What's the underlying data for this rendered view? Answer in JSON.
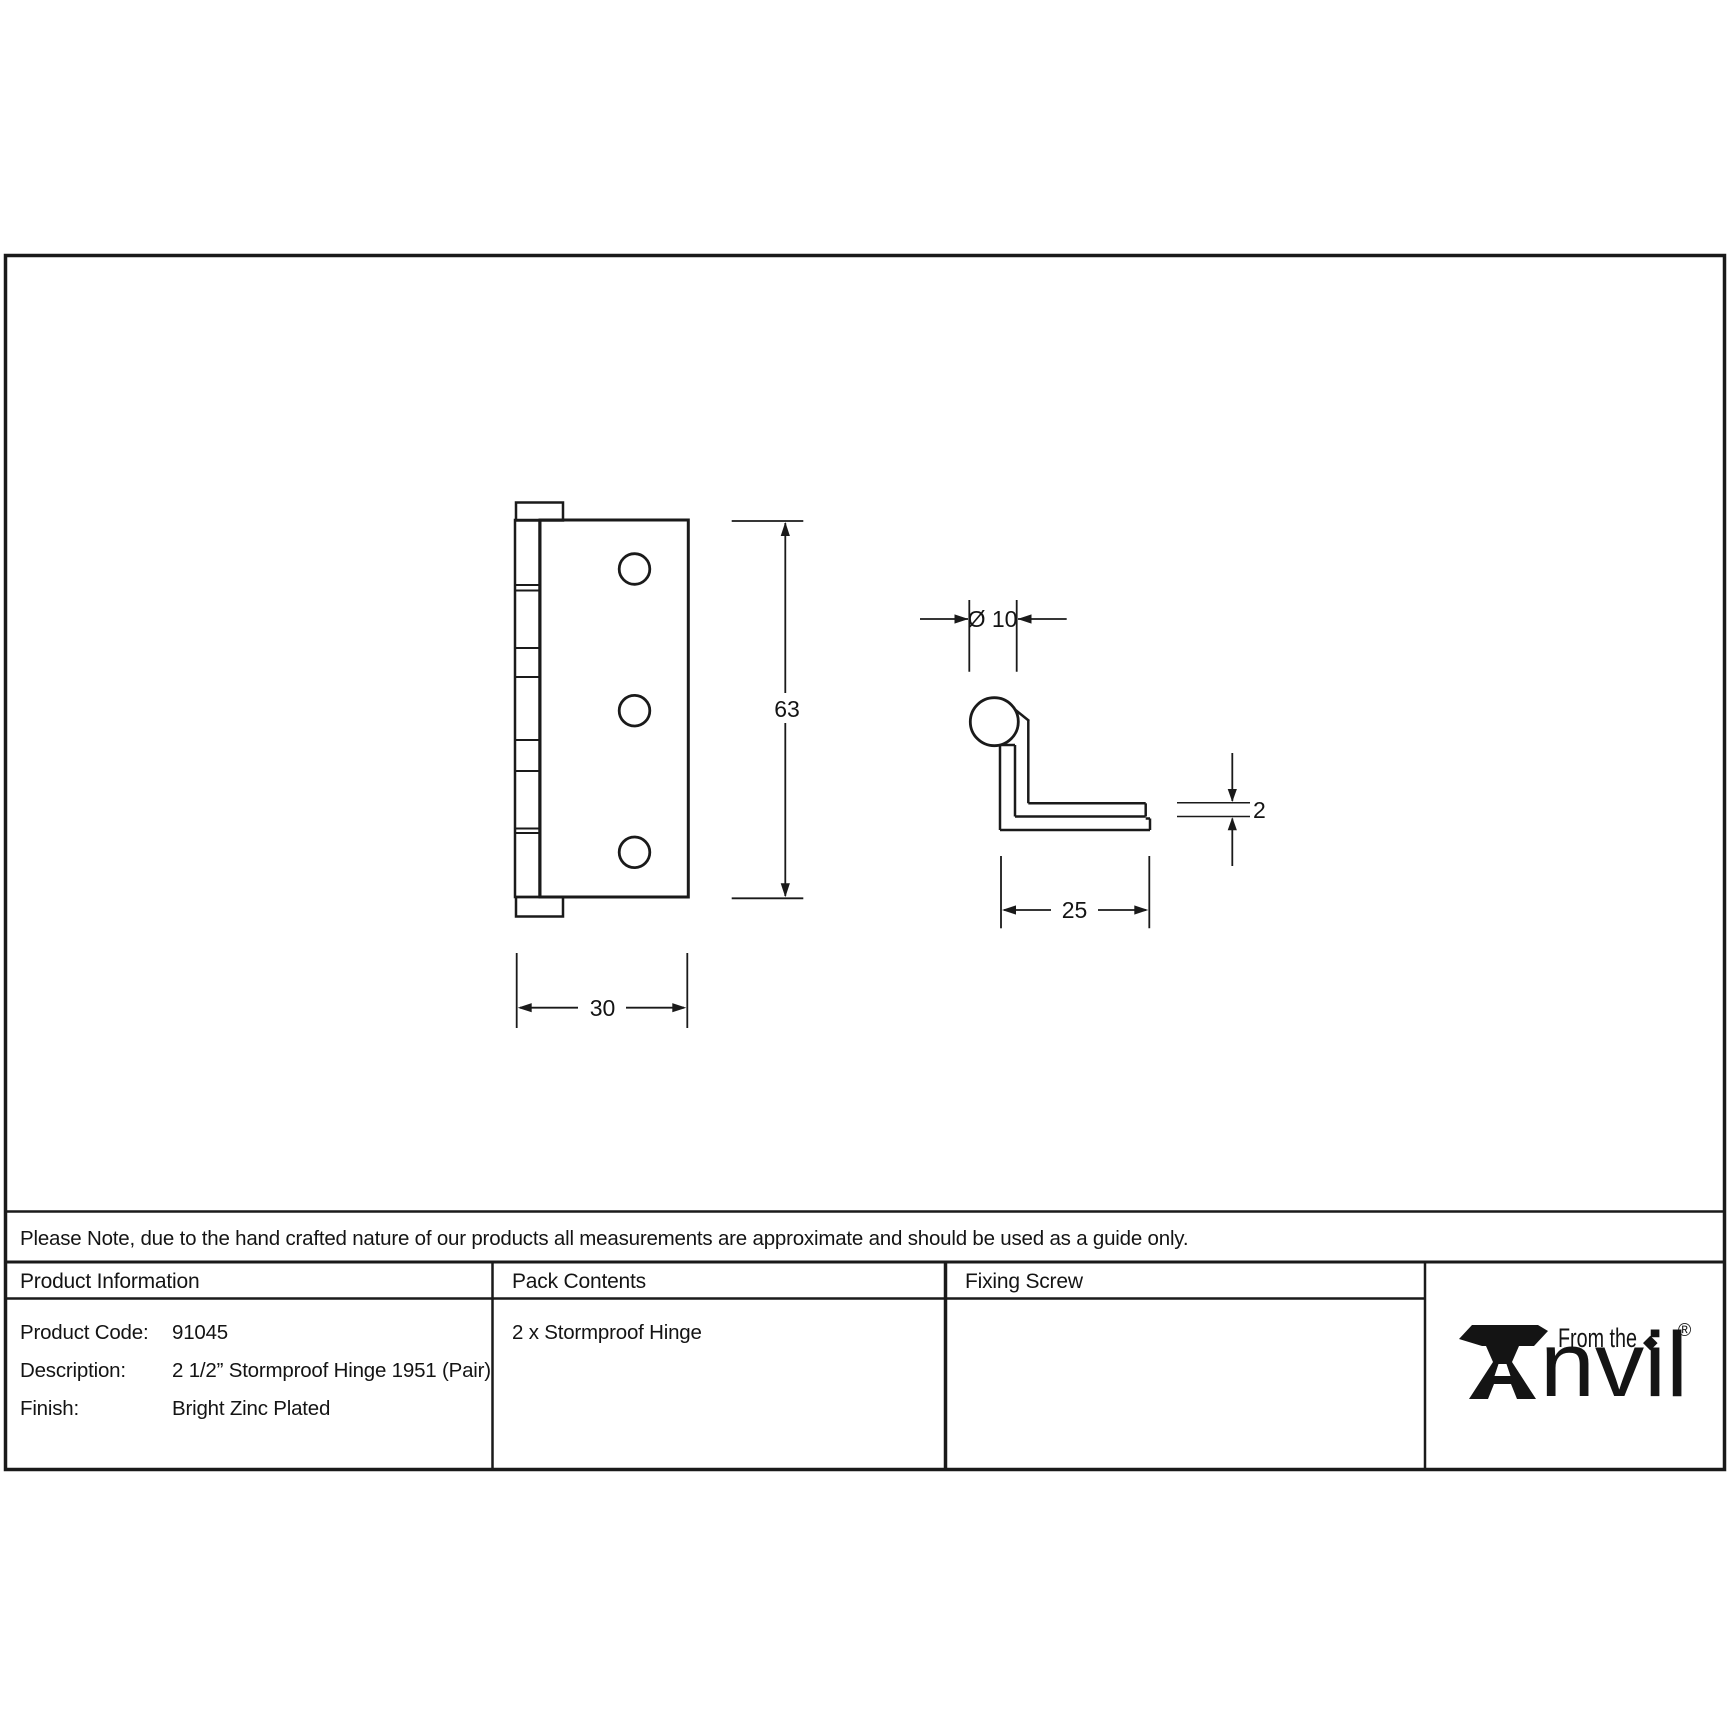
{
  "note": {
    "text": "Please Note, due to the hand crafted nature of our products all measurements are approximate and should be used as a guide only."
  },
  "drawing": {
    "front_view": {
      "height_dim": "63",
      "width_dim": "30"
    },
    "side_view": {
      "knuckle_diameter_dim": "Ø 10",
      "leaf_thickness_dim": "2",
      "leaf_width_dim": "25"
    }
  },
  "table": {
    "headers": {
      "product_information": "Product Information",
      "pack_contents": "Pack Contents",
      "fixing_screw": "Fixing Screw"
    },
    "product_information": {
      "rows": [
        {
          "label": "Product Code:",
          "value": "91045"
        },
        {
          "label": "Description:",
          "value": "2 1/2” Stormproof Hinge 1951 (Pair)"
        },
        {
          "label": "Finish:",
          "value": "Bright Zinc Plated"
        }
      ]
    },
    "pack_contents": {
      "value": "2 x Stormproof Hinge"
    }
  },
  "logo": {
    "from_the": "From the",
    "anvil_text": "nvil",
    "diamond": "◆",
    "registered": "®"
  },
  "colors": {
    "ink": "#1a1a1a",
    "paper": "#ffffff"
  }
}
